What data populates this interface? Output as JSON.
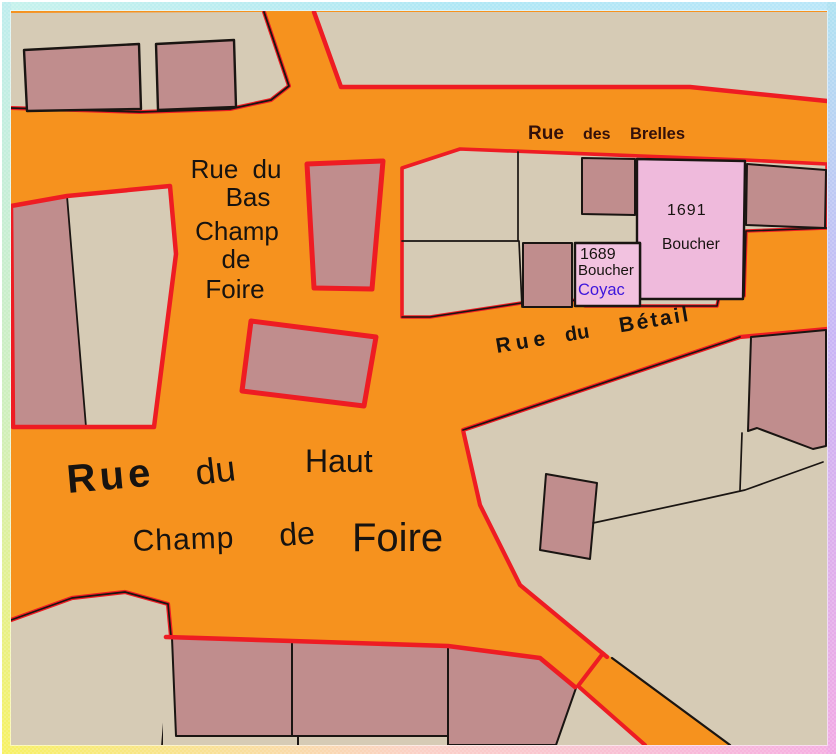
{
  "colors": {
    "street": "#F6921E",
    "beige": "#D6CBB5",
    "building": "#C08D8D",
    "lp1691": "#EFBADC",
    "lp1689": "#F2C2E0",
    "red": "#EE1C23",
    "line": "#1A1512",
    "textdark": "#171310",
    "brelles": "#33100A",
    "coyac": "#3D16DC",
    "border_cyan": "#AFE7F5",
    "border_yellow": "#F7F163",
    "border_pink": "#F6ADE2",
    "border_violet": "#C9B5F6"
  },
  "streets": {
    "brelles": {
      "words": [
        "Rue",
        "des",
        "Brelles"
      ]
    },
    "bas_champ_de_foire": {
      "lines": [
        "Rue du",
        "Bas",
        "Champ",
        "de",
        "Foire"
      ]
    },
    "betail": {
      "words": [
        "Rue",
        "du",
        "Bétail"
      ]
    },
    "haut_champ_de_foire": {
      "words": [
        "Rue",
        "du",
        "Haut",
        "Champ",
        "de",
        "Foire"
      ]
    }
  },
  "parcels": {
    "p1691": {
      "number": "1691",
      "occupant": "Boucher"
    },
    "p1689": {
      "number": "1689",
      "occupant": "Boucher",
      "name": "Coyac"
    }
  }
}
